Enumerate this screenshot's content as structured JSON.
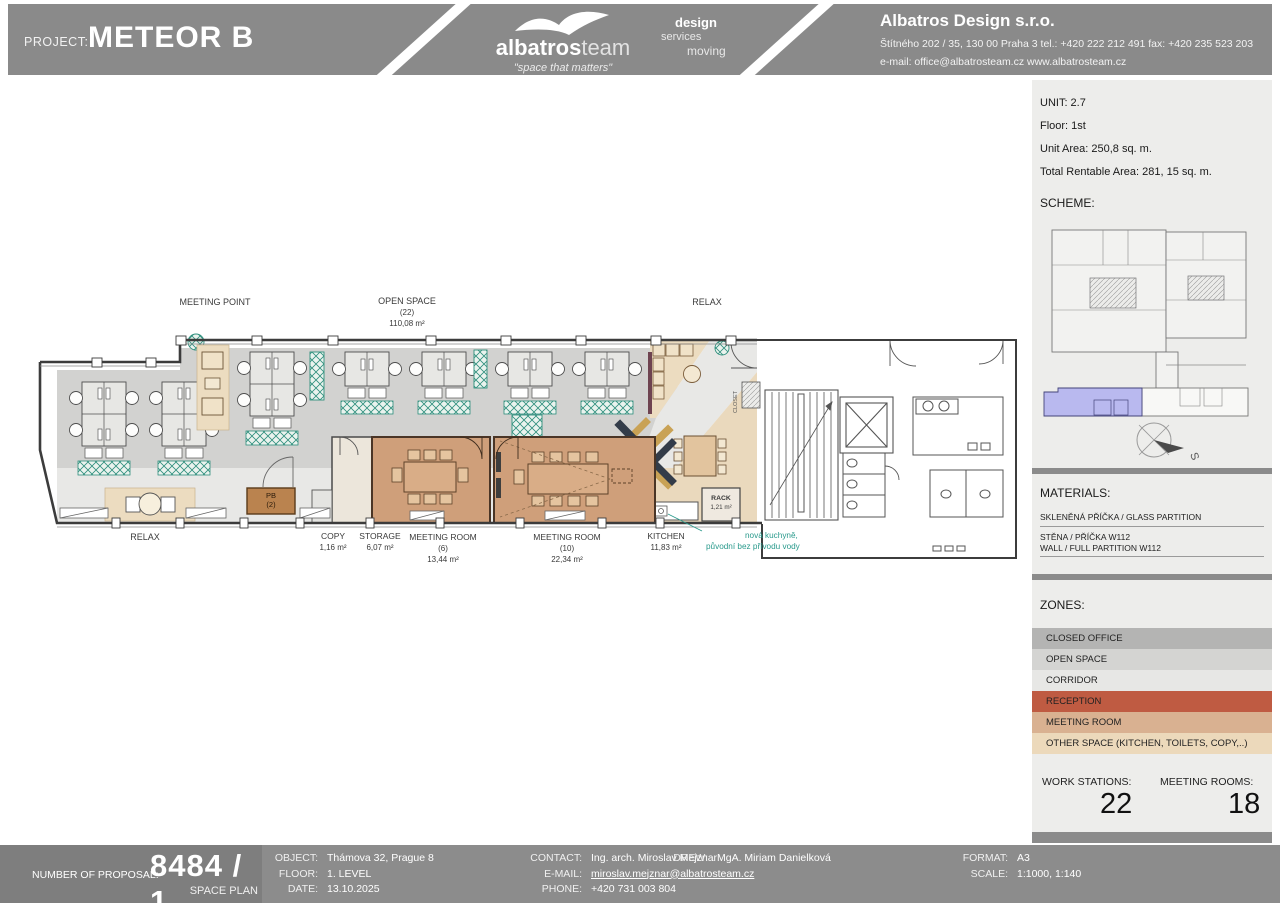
{
  "header": {
    "project_label": "PROJECT:",
    "project_name": "METEOR B",
    "logo_bold": "albatros",
    "logo_light": "team",
    "logo_tagline": "\"space that matters\"",
    "service_1": "design",
    "service_2": "services",
    "service_3": "moving",
    "company_name": "Albatros Design s.r.o.",
    "company_address": "Štítného 202 / 35, 130 00 Praha 3  tel.: +420 222 212 491  fax: +420 235 523 203",
    "company_email": "e-mail: office@albatrosteam.cz  www.albatrosteam.cz"
  },
  "sidebar": {
    "unit": "UNIT: 2.7",
    "floor": "Floor: 1st",
    "unit_area": "Unit Area: 250,8 sq. m.",
    "total_rentable": "Total Rentable Area: 281, 15 sq. m.",
    "scheme_label": "SCHEME:",
    "compass_label": "S",
    "materials_label": "MATERIALS:",
    "material_1_line1": "SKLENĚNÁ PŘÍČKA / GLASS PARTITION",
    "material_2_line1": "STĚNA / PŘÍČKA W112",
    "material_2_line2": "WALL / FULL PARTITION W112",
    "zones_label": "ZONES:",
    "zones": [
      {
        "label": "CLOSED OFFICE",
        "color": "#b4b4b3"
      },
      {
        "label": "OPEN SPACE",
        "color": "#d4d4d2"
      },
      {
        "label": "CORRIDOR",
        "color": "#e7e7e5"
      },
      {
        "label": "RECEPTION",
        "color": "#bf5b42"
      },
      {
        "label": "MEETING ROOM",
        "color": "#d9b191"
      },
      {
        "label": "OTHER SPACE (KITCHEN, TOILETS, COPY,..)",
        "color": "#ecd9bb"
      }
    ],
    "work_stations_label": "WORK STATIONS:",
    "work_stations": "22",
    "meeting_rooms_label": "MEETING ROOMS:",
    "meeting_rooms": "18"
  },
  "plan": {
    "labels": {
      "meeting_point": "MEETING POINT",
      "open_space": "OPEN SPACE",
      "open_space_count": "(22)",
      "open_space_area": "110,08 m²",
      "relax_top": "RELAX",
      "relax_bottom": "RELAX",
      "copy": "COPY",
      "copy_area": "1,16 m²",
      "storage": "STORAGE",
      "storage_area": "6,07 m²",
      "mr6": "MEETING ROOM",
      "mr6_count": "(6)",
      "mr6_area": "13,44 m²",
      "mr10": "MEETING ROOM",
      "mr10_count": "(10)",
      "mr10_area": "22,34 m²",
      "kitchen": "KITCHEN",
      "kitchen_area": "11,83 m²",
      "rack": "RACK",
      "rack_area": "1,21 m²",
      "pb": "PB",
      "pb_count": "(2)",
      "closet": "CLOSET",
      "note_line1": "nová kuchyně,",
      "note_line2": "původní bez přívodu vody",
      "note_color": "#2a9a8c"
    }
  },
  "footer": {
    "proposal_label": "NUMBER OF PROPOSAL:",
    "proposal_number": "8484 / 1",
    "proposal_type": "SPACE PLAN",
    "object_label": "OBJECT:",
    "object_value": "Thámova 32, Prague 8",
    "floor_label": "FLOOR:",
    "floor_value": "1. LEVEL",
    "date_label": "DATE:",
    "date_value": "13.10.2025",
    "contact_label": "CONTACT:",
    "contact_value": "Ing. arch. Miroslav Mejznar",
    "email_label": "E-MAIL:",
    "email_value": "miroslav.mejznar@albatrosteam.cz",
    "phone_label": "PHONE:",
    "phone_value": "+420 731 003 804",
    "drew_label": "DREW:",
    "drew_value": "MgA. Miriam Danielková",
    "format_label": "FORMAT:",
    "format_value": "A3",
    "scale_label": "SCALE:",
    "scale_value": "1:1000, 1:140"
  }
}
